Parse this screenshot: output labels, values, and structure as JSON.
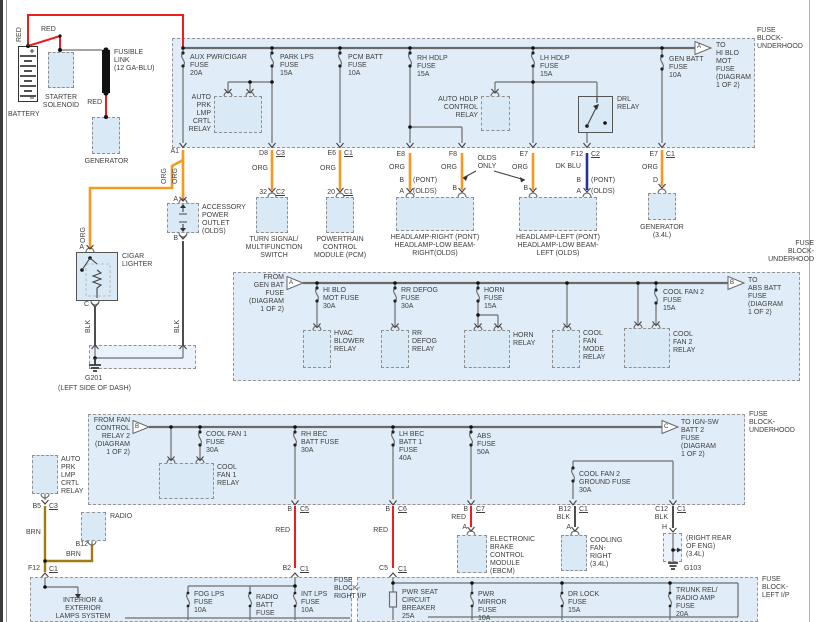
{
  "source": {
    "battery": "BATTERY",
    "red_vertical": "RED",
    "red_jumper": "RED",
    "red_link": "RED",
    "starter_solenoid": "STARTER\nSOLENOID",
    "fusible_link": "FUSIBLE\nLINK\n(12 GA-BLU)",
    "generator": "GENERATOR"
  },
  "top_block": {
    "title": "FUSE\nBLOCK-\nUNDERHOOD",
    "fuse_aux": "AUX PWR/CIGAR\nFUSE\n20A",
    "fuse_park": "PARK LPS\nFUSE\n15A",
    "fuse_pcm": "PCM BATT\nFUSE\n10A",
    "fuse_rh": "RH HDLP\nFUSE\n15A",
    "fuse_lh": "LH HDLP\nFUSE\n15A",
    "fuse_gen": "GEN BATT\nFUSE\n10A",
    "relay_auto_prk": "AUTO\nPRK\nLMP\nCRTL\nRELAY",
    "relay_auto_hdlp": "AUTO HDLP\nCONTROL\nRELAY",
    "relay_drl": "DRL\nRELAY",
    "arrow_letter": "A",
    "offpage": "TO\nHI BLO\nMOT\nFUSE\n(DIAGRAM\n1 OF 2)"
  },
  "conn_row": {
    "a1": "A1",
    "org_v1": "ORG",
    "org_v2": "ORG",
    "d8": "D8",
    "d8_c": "C3",
    "org_d8": "ORG",
    "p32": "32",
    "p32_c": "C2",
    "e6": "E6",
    "e6_c": "C1",
    "org_e6": "ORG",
    "p20": "20",
    "p20_c": "C1",
    "e8": "E8",
    "org_e8": "ORG",
    "hr_b": "B",
    "hr_pont": "(PONT)",
    "hr_a": "A",
    "hr_olds": "(OLDS)",
    "f8": "F8",
    "org_f8": "ORG",
    "f8_b": "B",
    "olds_only": "OLDS\nONLY",
    "e7": "E7",
    "org_e7": "ORG",
    "e7_b": "B",
    "f12": "F12",
    "f12_c": "C2",
    "dk_blu": "DK BLU",
    "hl_b": "B",
    "hl_pont": "(PONT)",
    "hl_a": "A",
    "hl_olds": "(OLDS)",
    "e7g": "E7",
    "e7g_c": "C1",
    "org_gen": "ORG",
    "gen_d": "D"
  },
  "lighter_circuit": {
    "outlet": "ACCESSORY\nPOWER\nOUTLET\n(OLDS)",
    "outlet_a": "A",
    "outlet_b": "B",
    "blk_outlet": "BLK",
    "org_cigar": "ORG",
    "cigar_a": "A",
    "cigar": "CIGAR\nLIGHTER",
    "cigar_c": "C",
    "blk_cigar": "BLK",
    "g201": "G201",
    "g201_loc": "(LEFT SIDE OF DASH)"
  },
  "components": {
    "turn": "TURN SIGNAL/\nMULTIFUNCTION\nSWITCH",
    "pcm": "POWERTRAIN\nCONTROL\nMODULE (PCM)",
    "head_r": "HEADLAMP-RIGHT   (PONT)\nHEADLAMP-LOW BEAM-\nRIGHT(OLDS)",
    "head_l": "HEADLAMP-LEFT   (PONT)\nHEADLAMP-LOW BEAM-\nLEFT (OLDS)",
    "gen34": "GENERATOR\n(3.4L)"
  },
  "mid_block": {
    "title": "FUSE\nBLOCK-\nUNDERHOOD",
    "from": "FROM\nGEN BAT\nFUSE\n(DIAGRAM\n1 OF 2)",
    "arrow_in": "A",
    "arrow_out": "B",
    "offpage": "TO\nABS BATT\nFUSE\n(DIAGRAM\n1 OF 2)",
    "fuse_hiblo": "HI BLO\nMOT FUSE\n30A",
    "fuse_defog": "RR DEFOG\nFUSE\n30A",
    "fuse_horn": "HORN\nFUSE\n15A",
    "fuse_cf2": "COOL FAN 2\nFUSE\n15A",
    "relay_hvac": "HVAC\nBLOWER\nRELAY",
    "relay_defog": "RR\nDEFOG\nRELAY",
    "relay_horn": "HORN\nRELAY",
    "relay_mode": "COOL\nFAN\nMODE\nRELAY",
    "relay_cf2": "COOL\nFAN 2\nRELAY"
  },
  "bot_block": {
    "title": "FUSE\nBLOCK-\nUNDERHOOD",
    "from": "FROM FAN\nCONTROL\nRELAY 2\n(DIAGRAM\n1 OF 2)",
    "arrow_in": "B",
    "arrow_out": "C",
    "offpage": "TO IGN-SW\nBATT 2\nFUSE\n(DIAGRAM\n1 OF 2)",
    "fuse_cf1": "COOL FAN 1\nFUSE\n30A",
    "relay_cf1": "COOL\nFAN 1\nRELAY",
    "fuse_rh_bec": "RH BEC\nBATT FUSE\n30A",
    "fuse_lh_bec": "LH BEC\nBATT 1\nFUSE\n40A",
    "fuse_abs": "ABS\nFUSE\n50A",
    "fuse_cf2_gnd": "COOL FAN 2\nGROUND FUSE\n30A"
  },
  "left_branch": {
    "relay": "AUTO\nPRK\nLMP\nCRTL\nRELAY",
    "b5": "B5",
    "b5_c": "C3",
    "brn1": "BRN",
    "radio": "RADIO",
    "b12": "B12",
    "brn2": "BRN",
    "f12": "F12",
    "f12_c": "C1"
  },
  "exits": {
    "b1": "B",
    "c5": "C5",
    "red1": "RED",
    "b2": "B2",
    "b2_c": "C1",
    "b2x": "B",
    "c6": "C6",
    "red2": "RED",
    "c5b": "C5",
    "c5b_c": "C1",
    "b3": "B",
    "c7": "C7",
    "red3": "RED",
    "a_ebcm": "A",
    "ebcm": "ELECTRONIC\nBRAKE\nCONTROL\nMODULE\n(EBCM)",
    "b12": "B12",
    "b12_c": "C1",
    "blk1": "BLK",
    "a_fan": "A",
    "cooling_fan": "COOLING\nFAN-\nRIGHT\n(3.4L)",
    "c12": "C12",
    "c12_c": "C1",
    "blk2": "BLK",
    "h_pin": "H",
    "g103_loc": "(RIGHT REAR\nOF ENG)\n(3.4L)",
    "g103": "G103"
  },
  "right_ip": {
    "title": "FUSE\nBLOCK-\nRIGHT I/P",
    "system": "INTERIOR &\nEXTERIOR\nLAMPS SYSTEM",
    "fuse_fog": "FOG LPS\nFUSE\n10A",
    "fuse_radio": "RADIO\nBATT\nFUSE",
    "fuse_int": "INT LPS\nFUSE\n10A"
  },
  "left_ip": {
    "title": "FUSE\nBLOCK-\nLEFT I/P",
    "breaker_seat": "PWR SEAT\nCIRCUIT\nBREAKER\n25A",
    "fuse_mirror": "PWR\nMIRROR\nFUSE\n10A",
    "fuse_lock": "DR LOCK\nFUSE\n15A",
    "fuse_trunk": "TRUNK REL/\nRADIO AMP\nFUSE\n20A"
  },
  "colors": {
    "wire_red": "#ee1c1c",
    "wire_org": "#f6991e",
    "wire_dkblu": "#24329d",
    "wire_brn": "#a07c14",
    "wire_blk": "#3a3a3a",
    "box_fill": "#dceaf6"
  }
}
